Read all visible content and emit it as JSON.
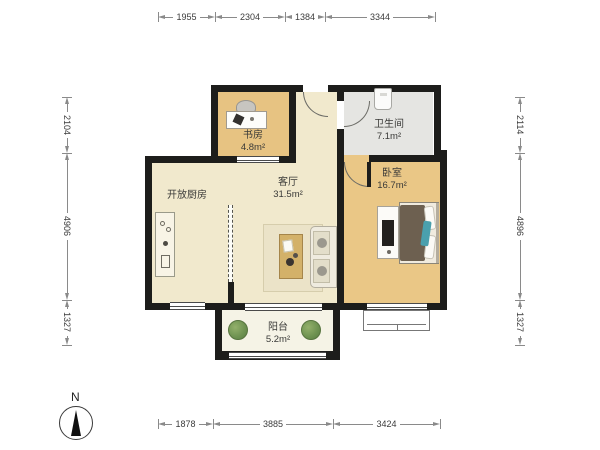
{
  "page": {
    "type": "apartment-floor-plan"
  },
  "colors": {
    "wall": "#1d1d1b",
    "living_floor": "#f1e9cd",
    "study_floor": "#e7c382",
    "bedroom_floor": "#eac786",
    "bathroom_floor": "#e5e5e2",
    "balcony_floor": "#f5f3e6",
    "blanket_brown": "#6d6050",
    "accent_teal": "#4aa0ad",
    "plant_green": "#6d9150"
  },
  "compass": {
    "north_label": "N"
  },
  "rooms": {
    "study": {
      "name": "书房",
      "area": "4.8m²"
    },
    "bathroom": {
      "name": "卫生间",
      "area": "7.1m²"
    },
    "living_room": {
      "name": "客厅",
      "area": "31.5m²"
    },
    "open_kitchen": {
      "name": "开放厨房"
    },
    "bedroom": {
      "name": "卧室",
      "area": "16.7m²"
    },
    "balcony": {
      "name": "阳台",
      "area": "5.2m²"
    }
  },
  "dimensions": {
    "top": [
      {
        "label": "1955"
      },
      {
        "label": "2304"
      },
      {
        "label": "1384"
      },
      {
        "label": "3344"
      }
    ],
    "bottom": [
      {
        "label": "1878"
      },
      {
        "label": "3885"
      },
      {
        "label": "3424"
      }
    ],
    "left": [
      {
        "label": "2104"
      },
      {
        "label": "4906"
      },
      {
        "label": "1327"
      }
    ],
    "right": [
      {
        "label": "2114"
      },
      {
        "label": "4896"
      },
      {
        "label": "1327"
      }
    ]
  }
}
